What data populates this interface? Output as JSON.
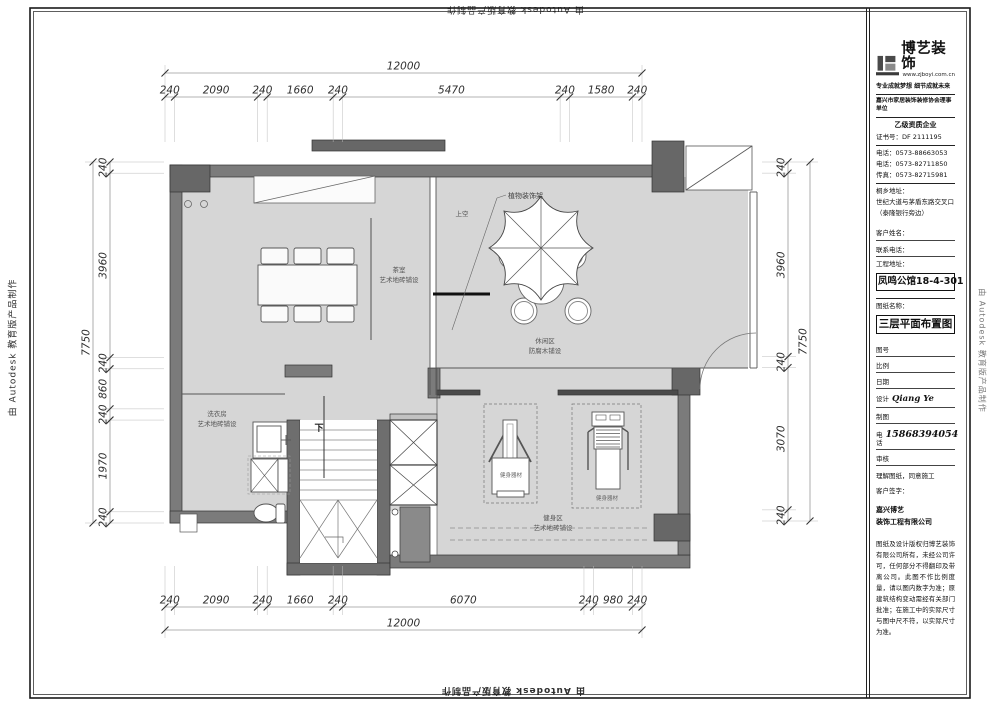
{
  "watermarks": {
    "side": "由 Autodesk 教育版产品制作",
    "top": "由 Autodesk 教育版产品制作",
    "bottom": "由 Autodesk 教育版产品制作"
  },
  "colors": {
    "floor": "#d6d6d6",
    "wall": "#7b7b7b",
    "wall_dark": "#676767",
    "line": "#444444"
  },
  "title_block": {
    "brand_name": "博艺装饰",
    "brand_url": "www.zjboyi.com.cn",
    "slogan": "专业成就梦想 细节成就未来",
    "association": "嘉兴市家居装饰装修协会理事单位",
    "grade": "乙级资质企业",
    "cert_label": "证书号：",
    "cert_no": "DF 2111195",
    "tel1": "电话：0573-88663053",
    "tel2": "电话：0573-82711850",
    "fax": "传真：0573-82715981",
    "addr_label": "桐乡地址：",
    "addr_line1": "世纪大道与茅盾东路交叉口",
    "addr_line2": "（泰隆银行旁边）",
    "client_name_label": "客户姓名：",
    "contact_label": "联系电话：",
    "project_addr_label": "工程地址：",
    "project_name": "凤鸣公馆18-4-301",
    "drawing_name_label": "图纸名称：",
    "drawing_name": "三层平面布置图",
    "fig_no_label": "图号",
    "scale_label": "比例",
    "date_label": "日期",
    "design_label": "设计",
    "designer": "Qiang Ye",
    "draft_label": "制图",
    "phone_label": "电话",
    "phone": "15868394054",
    "review_label": "审核",
    "agree_note": "理解图纸，同意施工",
    "sign_label": "客户签字：",
    "company_line1": "嘉兴博艺",
    "company_line2": "装饰工程有限公司",
    "disclaimer": "图纸及设计版权归博艺装饰有限公司所有，未经公司许可，任何部分不得翻印及带离公司。此图不作比例度量，请以图内数字为准；原建筑结构变动需经有关部门批准；在施工中的实际尺寸与图中尺不符，以实际尺寸为准。"
  },
  "dimensions": {
    "top": {
      "total": "12000",
      "segments": [
        240,
        2090,
        240,
        1660,
        240,
        5470,
        240,
        1580,
        240
      ]
    },
    "bottom": {
      "total": "12000",
      "segments": [
        240,
        2090,
        240,
        1660,
        240,
        6070,
        240,
        980,
        240
      ]
    },
    "left": {
      "total": "7750",
      "segments": [
        240,
        3960,
        240,
        860,
        240,
        1970,
        240
      ]
    },
    "right": {
      "total": "7750",
      "segments": [
        240,
        3960,
        240,
        3070,
        240
      ]
    }
  },
  "plan_labels": {
    "plant_rack": "植物装饰架",
    "open_above": "上空",
    "tea_room_name": "茶室",
    "tea_room_floor": "艺术地砖铺设",
    "leisure_name": "休闲区",
    "leisure_floor": "防腐木铺设",
    "laundry_name": "洗衣房",
    "laundry_floor": "艺术地砖铺设",
    "gym_name": "健身区",
    "gym_floor": "艺术地砖铺设",
    "equipment": "健身器材",
    "stairs_down": "下"
  }
}
